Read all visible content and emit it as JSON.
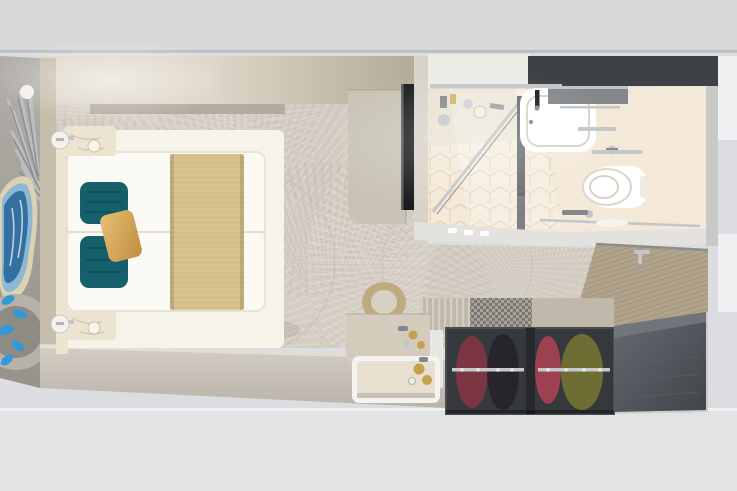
{
  "meta": {
    "title": "Top-down 3D render of a cruise ship stateroom floor plan",
    "image_kind": "photorealistic overhead cutaway render",
    "visible_text": "none"
  },
  "palette": {
    "bg-top": "#d7d8da",
    "bg-bottom": "#e2e3e5",
    "bg-side": "#dcdde0",
    "white-block": "#eff0f1",
    "carpet": "#d5cec5",
    "carpet-fan-light": "#e2dbd1",
    "carpet-fan-dark": "#c5bdb2",
    "carpet-line": "#bfb7ac",
    "wall-left": "#c6bcaa",
    "wall-light": "#ded6c8",
    "wall-dark": "#b3aa98",
    "wall-inner-band": "#aba59a",
    "wall-bottom-hi": "#d4cec4",
    "wall-bottom": "#b9b3a9",
    "partition": "#d8d3c9",
    "decor-floor": "#b1ada7",
    "decor-floor-dark": "#96928c",
    "tv-cabinet": "#c9c3b6",
    "tv-black": "#191b1e",
    "bath-floor": "#f4e9d8",
    "bath-tile-line": "#dcc9a9",
    "bath-dark-band": "#3e4145",
    "bath-wall-white": "#edebe6",
    "bath-south-wall": "#e4e2de",
    "vanity": "#e3d8c2",
    "sink-white": "#ffffff",
    "fixture-shadow": "#d9d2c4",
    "chrome": "#c3c6c9",
    "chrome-dark": "#84888c",
    "wood-door": "#b2a38c",
    "wood-door-line": "#9e8f78",
    "tile-floor": "#cecdc9",
    "tile-line": "#b9b8b4",
    "wardrobe-top": "#c0b9ab",
    "wardrobe-slat": "#d4cec1",
    "bench-dark": "#75726c",
    "bench-light": "#a3a099",
    "wardrobe-dark": "#35383c",
    "wardrobe-divider": "#26292c",
    "rail": "#c6c9cc",
    "cloth-maroon": "#7c3642",
    "cloth-dark": "#27252b",
    "cloth-red": "#9c4150",
    "cloth-olive": "#6d6d34",
    "cabinet-hi": "#666b72",
    "cabinet-lo": "#41454a",
    "desk": "#d3ccbd",
    "gold": "#c7a04e",
    "stool-ring": "#bfab7f",
    "stool-top": "#d7d1c3",
    "tray-rim": "#f4f3f0",
    "tray-face": "#e7e0d0",
    "bed-base": "#f6f3ea",
    "duvet": "#fcfaf5",
    "duvet-shadow": "#e3dccf",
    "runner": "#d8c28f",
    "runner-line": "#c5ad76",
    "pillow-teal": "#15616b",
    "pillow-teal-dark": "#0e4a54",
    "pillow-gold-hi": "#e8c076",
    "pillow-gold-lo": "#bf8d3f",
    "nightstand": "#ece4d1",
    "marble-vein": "#cdbd9e",
    "lamp": "#f4f2ed",
    "agate-rim": "#dcd1b2",
    "agate-blue": "#336f9f",
    "agate-blue-light": "#8db8d3",
    "plant-silver": "#bcbdbf",
    "plant-silver-dark": "#8c8d90",
    "chair-outer": "#b6b1a9",
    "chair-inner": "#8e8a84",
    "butterfly-blue": "#2d9ad9"
  },
  "scene": {
    "label": "cruise cabin seen from directly above",
    "bedroom": {
      "label": "bedroom with two twin beds pushed together on patterned fan carpet",
      "bed": {
        "label": "beds with white duvets, tan runner, two teal pillows and one gold accent pillow"
      },
      "nightstand_top": {
        "label": "cream marble nightstand with round wall lamp"
      },
      "nightstand_bottom": {
        "label": "cream marble nightstand with round wall lamp"
      },
      "tv": {
        "label": "wall TV on light wood media cabinet"
      },
      "decor": {
        "label": "silver frond plant, blue agate artwork and round lounge chair with blue butterflies"
      }
    },
    "bathroom": {
      "label": "bathroom with glass shower, white basin, toilet and cube-pattern tile floor",
      "sink": {
        "label": "white countertop basin with black faucet"
      },
      "toilet": {
        "label": "wall-hung white toilet"
      },
      "shower": {
        "label": "glass shower enclosure over beige cube tiles"
      }
    },
    "entry": {
      "label": "entry hall with wood cabin door and grey tile floor",
      "door": {
        "label": "wood entry door with chrome handle"
      }
    },
    "storage": {
      "label": "open wardrobe with hanging clothes, patterned luggage bench and dark cabinet",
      "wardrobe": {
        "label": "two-bay wardrobe with maroon, black, red and olive garments on chrome rails"
      },
      "desk": {
        "label": "vanity desk with gold stool and service tray with bottles"
      }
    }
  }
}
